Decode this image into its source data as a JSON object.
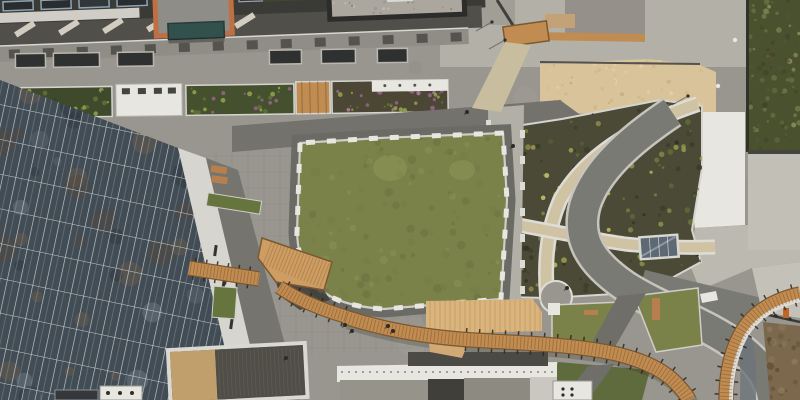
{
  "scene": {
    "description": "Aerial drone view straight down onto a new urban plaza: a glass office building lower-left, a large central lawn edged with white bench modules, a curving wooden boardwalk ramp, curved planting beds with beige paths on the right, a sand-colored roof terrace and green roof at top right, and rooftops along the top and bottom edges.",
    "palette": {
      "plazaBase": "#98968e",
      "plazaLight": "#a8a69e",
      "plazaTopRight": "#b3b0a8",
      "asphaltTop": "#504f4a",
      "roofDark": "#3a3a37",
      "walkwayDark": "#73726c",
      "facadeBand": "#8f8d86",
      "lawnBase": "#7a8149",
      "lawnLight": "#929a5a",
      "lawnDark": "#5f6b3c",
      "soil": "#4b4a36",
      "shrubGreen": "#5f7037",
      "shrubLight": "#8fa04b",
      "shrubYellow": "#b5b356",
      "flowerPurple": "#96628c",
      "wood": "#c08c52",
      "woodLight": "#cd9d63",
      "woodDark": "#7c5930",
      "plywood": "#dab47d",
      "sand": "#d9c39a",
      "whiteConc": "#e7e6e0",
      "curbWhite": "#dcdbd5",
      "glass": "#414c55",
      "glassLight": "#5d6974",
      "mullion": "#c9cdcf",
      "greenRoof": "#4a512f",
      "roadGray": "#7a7a74",
      "roadBlue": "#6d747b",
      "dirt": "#7b684d",
      "terracotta": "#bf6f42",
      "teal": "#33514c",
      "boxDark": "#3c4248",
      "concLedge": "#d7d5cf",
      "beigePath": "#cfc3a4",
      "benchWood": "#b5804d"
    },
    "people": [
      [
        345,
        325
      ],
      [
        352,
        331
      ],
      [
        388,
        326
      ],
      [
        393,
        331
      ],
      [
        567,
        288
      ],
      [
        513,
        146
      ],
      [
        467,
        112
      ],
      [
        286,
        358
      ]
    ],
    "poles": [
      [
        492,
        22
      ],
      [
        505,
        40
      ],
      [
        688,
        96
      ]
    ],
    "whiteDots": [
      [
        735,
        40
      ],
      [
        718,
        86
      ]
    ]
  }
}
